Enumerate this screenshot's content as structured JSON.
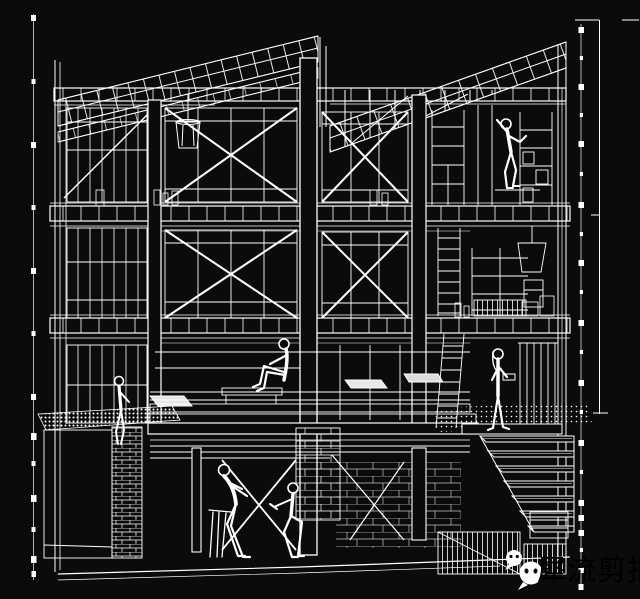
{
  "colors": {
    "background": "#0b0b0b",
    "line": "#ffffff",
    "watermark_text": "#d4d4d4",
    "wechat_bubble_fill": "#ffffff"
  },
  "watermark": {
    "text": "犀流剪报",
    "icons": [
      {
        "name": "wechat-bubble-icon-small"
      },
      {
        "name": "wechat-bubble-icon-large"
      }
    ]
  },
  "scene": {
    "description": "White-on-black architectural section perspective wireframe of a three-storey timber-framed house: butterfly roof with joists, cross-braced window bays, ladders, shelving, a staircase descending right, a planter at left, brick and rubble textures in the basement, and six human figures.",
    "people": [
      "person-climbing-shelf",
      "person-sitting-on-platform",
      "person-standing-by-stairs",
      "person-sitting-on-planter-edge",
      "person-sitting-on-stool",
      "person-crouching"
    ],
    "annotations": [
      "left-chain-line",
      "right-chain-line",
      "right-dimension-line"
    ]
  }
}
